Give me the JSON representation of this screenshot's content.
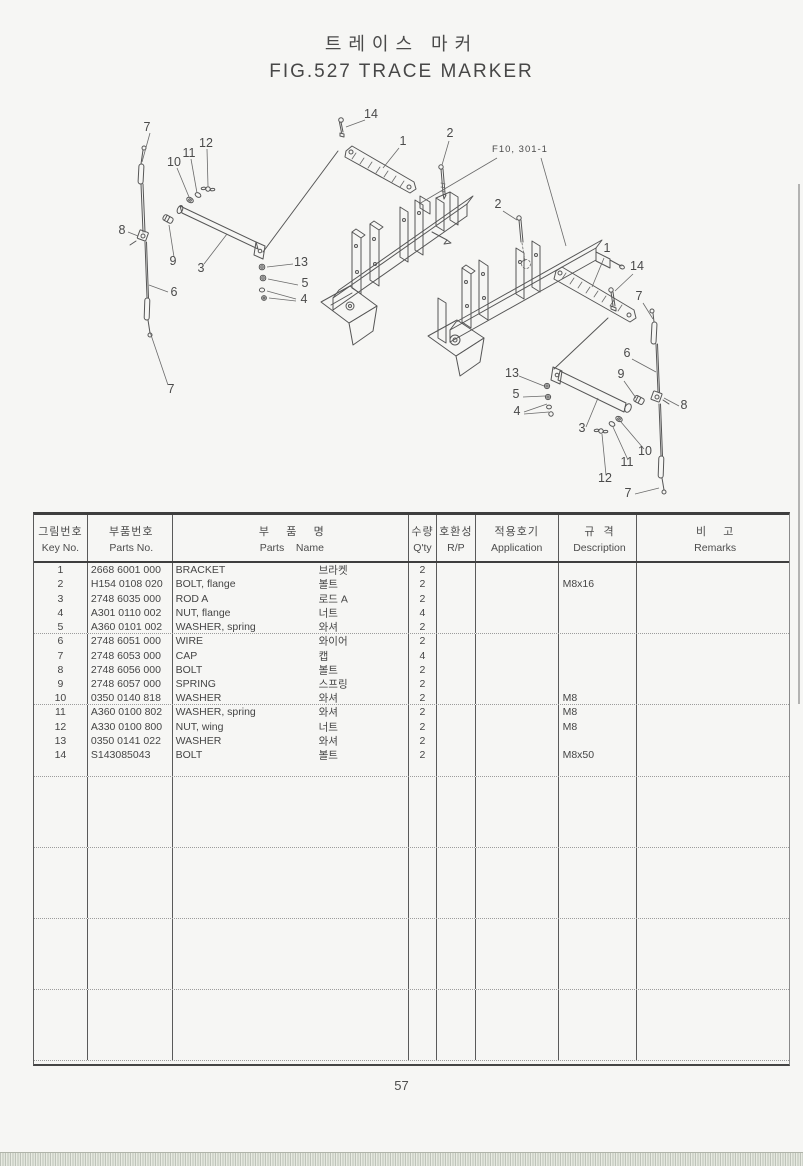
{
  "page": {
    "title_ko": "트레이스 마커",
    "title_en": "FIG.527  TRACE MARKER",
    "page_number": "57"
  },
  "diagram": {
    "figure_ref": "F10, 301-1",
    "callouts": [
      {
        "label": "7",
        "x": 147,
        "y": 131
      },
      {
        "label": "12",
        "x": 206,
        "y": 147
      },
      {
        "label": "11",
        "x": 189,
        "y": 157
      },
      {
        "label": "10",
        "x": 174,
        "y": 166
      },
      {
        "label": "8",
        "x": 122,
        "y": 234
      },
      {
        "label": "9",
        "x": 173,
        "y": 265
      },
      {
        "label": "3",
        "x": 201,
        "y": 272
      },
      {
        "label": "6",
        "x": 174,
        "y": 296
      },
      {
        "label": "7",
        "x": 171,
        "y": 393
      },
      {
        "label": "13",
        "x": 301,
        "y": 266
      },
      {
        "label": "5",
        "x": 305,
        "y": 287
      },
      {
        "label": "4",
        "x": 304,
        "y": 303
      },
      {
        "label": "14",
        "x": 371,
        "y": 118
      },
      {
        "label": "1",
        "x": 403,
        "y": 145
      },
      {
        "label": "2",
        "x": 450,
        "y": 137
      },
      {
        "label": "2",
        "x": 498,
        "y": 208
      },
      {
        "label": "1",
        "x": 607,
        "y": 252
      },
      {
        "label": "14",
        "x": 637,
        "y": 270
      },
      {
        "label": "7",
        "x": 639,
        "y": 300
      },
      {
        "label": "6",
        "x": 627,
        "y": 357
      },
      {
        "label": "9",
        "x": 621,
        "y": 378
      },
      {
        "label": "8",
        "x": 684,
        "y": 409
      },
      {
        "label": "13",
        "x": 512,
        "y": 377
      },
      {
        "label": "5",
        "x": 516,
        "y": 398
      },
      {
        "label": "4",
        "x": 517,
        "y": 415
      },
      {
        "label": "3",
        "x": 582,
        "y": 432
      },
      {
        "label": "10",
        "x": 645,
        "y": 455
      },
      {
        "label": "11",
        "x": 627,
        "y": 466
      },
      {
        "label": "12",
        "x": 605,
        "y": 482
      },
      {
        "label": "7",
        "x": 628,
        "y": 497
      }
    ]
  },
  "table": {
    "headers": {
      "key_no": {
        "ko": "그림번호",
        "en": "Key No."
      },
      "parts_no": {
        "ko": "부품번호",
        "en": "Parts No."
      },
      "parts_name": {
        "ko": "부    품    명",
        "en": "Parts    Name"
      },
      "qty": {
        "ko": "수량",
        "en": "Q'ty"
      },
      "rp": {
        "ko": "호환성",
        "en": "R/P"
      },
      "application": {
        "ko": "적용호기",
        "en": "Application"
      },
      "description": {
        "ko": "규  격",
        "en": "Description"
      },
      "remarks": {
        "ko": "비    고",
        "en": "Remarks"
      }
    },
    "rows": [
      {
        "key": "1",
        "parts_no": "2668 6001 000",
        "name_en": "BRACKET",
        "name_ko": "브라켓",
        "qty": "2",
        "rp": "",
        "application": "",
        "description": "",
        "remarks": ""
      },
      {
        "key": "2",
        "parts_no": "H154 0108 020",
        "name_en": "BOLT, flange",
        "name_ko": "볼트",
        "qty": "2",
        "rp": "",
        "application": "",
        "description": "M8x16",
        "remarks": ""
      },
      {
        "key": "3",
        "parts_no": "2748 6035 000",
        "name_en": "ROD A",
        "name_ko": "로드 A",
        "qty": "2",
        "rp": "",
        "application": "",
        "description": "",
        "remarks": ""
      },
      {
        "key": "4",
        "parts_no": "A301 0110 002",
        "name_en": "NUT, flange",
        "name_ko": "너트",
        "qty": "4",
        "rp": "",
        "application": "",
        "description": "",
        "remarks": ""
      },
      {
        "key": "5",
        "parts_no": "A360 0101 002",
        "name_en": "WASHER, spring",
        "name_ko": "와셔",
        "qty": "2",
        "rp": "",
        "application": "",
        "description": "",
        "remarks": ""
      },
      {
        "key": "6",
        "parts_no": "2748 6051 000",
        "name_en": "WIRE",
        "name_ko": "와이어",
        "qty": "2",
        "rp": "",
        "application": "",
        "description": "",
        "remarks": ""
      },
      {
        "key": "7",
        "parts_no": "2748 6053 000",
        "name_en": "CAP",
        "name_ko": "캡",
        "qty": "4",
        "rp": "",
        "application": "",
        "description": "",
        "remarks": ""
      },
      {
        "key": "8",
        "parts_no": "2748 6056 000",
        "name_en": "BOLT",
        "name_ko": "볼트",
        "qty": "2",
        "rp": "",
        "application": "",
        "description": "",
        "remarks": ""
      },
      {
        "key": "9",
        "parts_no": "2748 6057 000",
        "name_en": "SPRING",
        "name_ko": "스프링",
        "qty": "2",
        "rp": "",
        "application": "",
        "description": "",
        "remarks": ""
      },
      {
        "key": "10",
        "parts_no": "0350 0140 818",
        "name_en": "WASHER",
        "name_ko": "와셔",
        "qty": "2",
        "rp": "",
        "application": "",
        "description": "M8",
        "remarks": ""
      },
      {
        "key": "11",
        "parts_no": "A360 0100 802",
        "name_en": "WASHER, spring",
        "name_ko": "와셔",
        "qty": "2",
        "rp": "",
        "application": "",
        "description": "M8",
        "remarks": ""
      },
      {
        "key": "12",
        "parts_no": "A330 0100 800",
        "name_en": "NUT, wing",
        "name_ko": "너트",
        "qty": "2",
        "rp": "",
        "application": "",
        "description": "M8",
        "remarks": ""
      },
      {
        "key": "13",
        "parts_no": "0350 0141 022",
        "name_en": "WASHER",
        "name_ko": "와셔",
        "qty": "2",
        "rp": "",
        "application": "",
        "description": "",
        "remarks": ""
      },
      {
        "key": "14",
        "parts_no": "S143085043",
        "name_en": "BOLT",
        "name_ko": "볼트",
        "qty": "2",
        "rp": "",
        "application": "",
        "description": "M8x50",
        "remarks": ""
      }
    ]
  }
}
